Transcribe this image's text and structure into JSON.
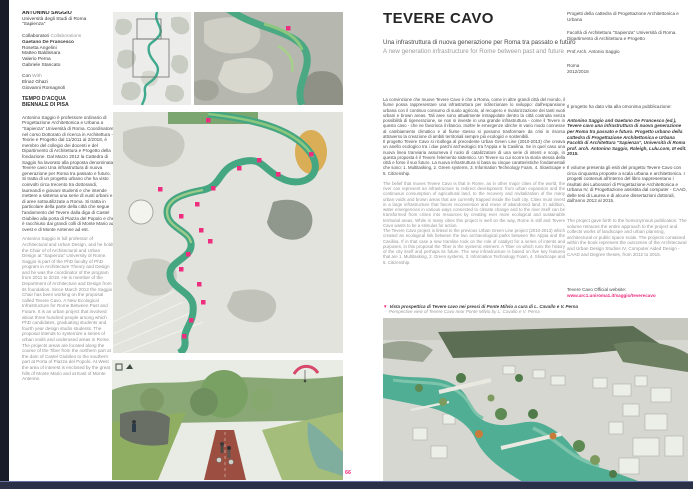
{
  "page": {
    "number": "66",
    "accent_color": "#ee2d7f",
    "river_color": "#45a682"
  },
  "left_column": {
    "author_heading": "ANTONINO SAGGIO",
    "affiliation_line1": "Università degli Studi di Roma",
    "affiliation_line2": "\"Sapienza\"",
    "collaborators_label_it": "Collaboratori",
    "collaborators_label_en": " Collaborations",
    "collaborators": [
      "Gaetano De Francesco",
      "Rosetta Angelini",
      "Matteo Baldissara",
      "Valerio Perna",
      "Gabriele Stancato"
    ],
    "with_label_it": "Con",
    "with_label_en": " With",
    "with_names": [
      "Elnaz Ghazi",
      "Giovanni Romagnoli"
    ],
    "event_line1": "TEMPO D'ACQUA",
    "event_line2": "BIENNALE DI PISA",
    "bio_it": "Antonino Saggio è professore ordinario di Progettazione Architettonica e Urbana a \"Sapienza\" Università di Roma. Coordinatore nel corso Dottorato di ricerca in Architettura - Teorie e Progetto dal 11/2011 al 2/2018, è membro del collegio dei docenti e del Dipartimento di Architettura e Progetto della fondazione. Dal Marzo 2012 la Cattedra di Saggio ha lavorato alla proposta denominata Tevere cavo Una infrastruttura di nuova generazione per Roma tra passato e futuro. Si tratta di un progetto urbano che ha visto coinvolti circa trecento tra dottorandi, laureandi e giovani studenti e che intende mettere a sistema una serie di vuoti urbani e di aree sottoutilizzate a Roma. Si tratta in particolare della parte della città che segue l'andamento del Tevere dalla diga di Castel Giubileo alla porta di Piazza del Popolo e che è racchiuso dai grandi colli di Monte Mario ad ovest e di Monte Antenne ad est.",
    "bio_en": "Antonino Saggio is full professor of Architectural and Urban Design, and he holds the Chair of of Architectural and Urban Design at \"Sapienza\" University of Rome. Saggio is part of the PhD faculty of PhD program in Architecture Theory and Design and he was the coordinator of the program from 2011 to 2018. He is member of the Department of Architecture and Design from its foundation. Since March 2012 the Saggio Chair has been working on the proposal called Tevere Cavo. A New Ecological Infrastructure for Rome Between Past and Future. It is an urban project that involved about three hundred people among which PhD candidates, graduating students and fourth year design studio students. The proposal intends to systemize a series of urban voids and underused areas in Rome. The projects areas are located along the course of the Tiber from the northern part at the dam of Castel Giubileo to the southern part at Porta of Piazza del Popolo. At West the area of interest is enclosed by the great hills of Monte Mario and at East of Monte Antenne."
  },
  "main": {
    "title": "TEVERE CAVO",
    "subtitle_it": "Una infrastruttura di nuova generazione per Roma tra passato e futuro",
    "subtitle_en": "A new generation infrastructure for Rome between past and future",
    "body_it_p1": "La convinzione che muove Tevere Cavo è che a Roma, come in altre grandi città del mondo, il fiume possa rappresentare una infrastruttura per ridirezionare lo sviluppo: dall'espansione urbana con il continuo consumo di suolo agricolo, al recupero e rivalorizzazione dei tanti vuoti urbani e brown areas. Tali aree sono attualmente intrappolate dentro la città costruita senza possibilità di rigenerazione, se non si investe in una grande infrastruttura - come il Tevere in questo caso - che ne favorisca il rilancio. Inoltre le emergenze idriche in vario modo connesse al cambiamento climatico e al fiume stesso si possono trasformare da crisi in risorsa attraverso la creazione di ambiti territoriali sempre più ecologici e sostenibili.",
    "body_it_p2": "Il progetto Tevere Cavo si ricollega al precedente Urban Green Line (2010-2013) che creava un anello ecologico tra i due parchi archeologici tra l'Appia e la Casilina. Se in quel caso una nuova linea tranviaria assumeva il ruolo di catalizzatore di una serie di intenti e scopi, in questa proposta è il Tevere l'elemento sistemico. Un Tevere su cui scorre la storia stessa della città e forse il suo futuro. La nuova infrastruttura si basa su cinque caratteristiche fondamentali che sono: 1. Multitasking, 2. Green systems, 3. Information Technology Foam, 4. SlowScape e 5. Citizenship.",
    "body_en_p1": "The belief that moves Tevere Cavo is that in Rome, as in other major cities of the world, the river can represent an infrastructure to redirect development: from urban expansion and the continuous consumption of agricultural land, to the recovery and revitalization of the many urban voids and brown areas that are currently trapped inside the built city. Cities must invest in a large infrastructure that favors reconversion and reuse of abandoned land. In addition, water emergencies in various ways connected to climate change and to the river itself can be transformed from crises into resources by creating ever more ecological and sustainable territorial areas. While in many cities this project is well on the way, Rome is still and Tevere Cavo wants to be a stimulus for action.",
    "body_en_p2": "The Tevere Cavo project is linked to the previous Urban Green Line project (2010-2013) which created an ecological link between the two archaeological parks between the Appia and the Casilina. If in that case a new tramline took on the role of catalyst for a series of intents and purposes, in this proposal the Tiber is the systemic element. A Tiber on which runs the history of the city itself and perhaps its future. The new infrastructure is based on five key features that are 1. Multitasking, 2. Green systems, 3. Information Technology Foam, 4. SlowScape and 5. Citizenship.",
    "caption_marker": "▼",
    "caption_it": "Vista prospettica di Tevere cavo nei pressi di Ponte Milvio a cura di L. Cavallo e V. Perna",
    "caption_en": "Perspective view of Tevere Cavo near Ponte Milvio by L. Cavallo e V. Perna"
  },
  "credits": {
    "chair": "Progetti della cattedra di Progettazione Architettonica e Urbana",
    "faculty": "Facoltà di Architettura \"Sapienza\" Università di Roma. Dipartimento di Architettura e Progetto",
    "professor": "Prof.Arch. Antonio Saggio",
    "city": "Roma",
    "years": "2012/2018",
    "publication_intro": "Il progetto ha dato vita alla omonima pubblicazione:",
    "publication_citation": "Antonino Saggio and Gaetano De Francesco (ed.), Tevere cavo una infrastruttura di nuova generazione per Roma tra passato e futuro. Progetto urbano della cattedra di Progettazione Architettonica e Urbana Facoltà di Architettura \"Sapienza\", Università di Roma prof. arch. Antonino Saggio, Raleigh, Lulu.com, III edit. 2015.",
    "volume_it": "Il volume presenta gli esiti del progetto Tevere Cavo con circa cinquanta proposte a scala urbana e architettonica. I progetti contenuti all'interno del libro rappresentano i risultati dei Laboratori di Progettazione Architettonica e Urbana IV, di Progettazione assistita dal computer - CAAD, delle tesi di Laurea e di alcune dissertazioni dottorali, dall'anno 2012 al 2015.",
    "volume_en": "The project gave birth to the homonymous publication. The volume retraces the entire approach to the project and collects works of landscape and urban planning, architectural or public space scale. The projects contained within the book represent the outcomes of the Architectural and Urban Design Studios IV, Computer Aided Design - CAAD and Degree theses, from 2012 to 2015.",
    "website_label": "Tevere Cavo Official website:",
    "website_url": "www.arc1.uniroma1.it/saggio/teverecavo"
  }
}
